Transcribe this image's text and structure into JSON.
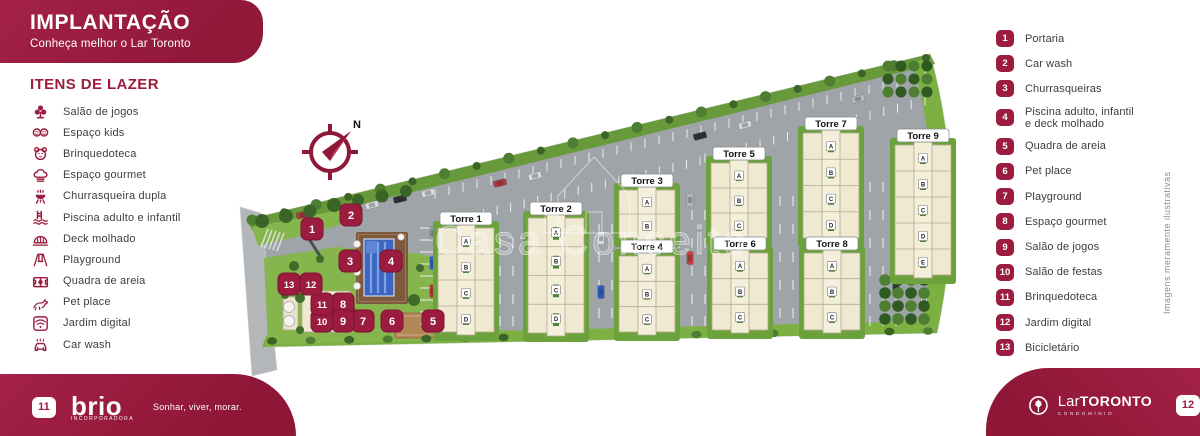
{
  "colors": {
    "brand": "#9b1c3f"
  },
  "header": {
    "title": "IMPLANTAÇÃO",
    "subtitle": "Conheça melhor o Lar Toronto"
  },
  "leisure": {
    "heading": "ITENS DE LAZER",
    "items": [
      {
        "icon": "game-room-icon",
        "label": "Salão de jogos"
      },
      {
        "icon": "kids-space-icon",
        "label": "Espaço kids"
      },
      {
        "icon": "toy-library-icon",
        "label": "Brinquedoteca"
      },
      {
        "icon": "gourmet-icon",
        "label": "Espaço gourmet"
      },
      {
        "icon": "bbq-icon",
        "label": "Churrasqueira dupla"
      },
      {
        "icon": "pool-icon",
        "label": "Piscina adulto e infantil"
      },
      {
        "icon": "wet-deck-icon",
        "label": "Deck molhado"
      },
      {
        "icon": "playground-icon",
        "label": "Playground"
      },
      {
        "icon": "sand-court-icon",
        "label": "Quadra de areia"
      },
      {
        "icon": "pet-place-icon",
        "label": "Pet place"
      },
      {
        "icon": "digital-garden-icon",
        "label": "Jardim digital"
      },
      {
        "icon": "car-wash-icon",
        "label": "Car wash"
      }
    ]
  },
  "legend": {
    "items": [
      {
        "number": "1",
        "label": "Portaria"
      },
      {
        "number": "2",
        "label": "Car wash"
      },
      {
        "number": "3",
        "label": "Churrasqueiras"
      },
      {
        "number": "4",
        "label": "Piscina adulto, infantil\ne deck molhado"
      },
      {
        "number": "5",
        "label": "Quadra de areia"
      },
      {
        "number": "6",
        "label": "Pet place"
      },
      {
        "number": "7",
        "label": "Playground"
      },
      {
        "number": "8",
        "label": "Espaço gourmet"
      },
      {
        "number": "9",
        "label": "Salão de jogos"
      },
      {
        "number": "10",
        "label": "Salão de festas"
      },
      {
        "number": "11",
        "label": "Brinquedoteca"
      },
      {
        "number": "12",
        "label": "Jardim digital"
      },
      {
        "number": "13",
        "label": "Bicicletário"
      }
    ]
  },
  "plan": {
    "watermark": "Casa Conceito",
    "compass_label": "N",
    "towers": [
      {
        "name": "Torre 1",
        "cx": 466,
        "top": 228,
        "h": 104,
        "sections": [
          "A",
          "B",
          "C",
          "D"
        ]
      },
      {
        "name": "Torre 2",
        "cx": 556,
        "top": 218,
        "h": 115,
        "sections": [
          "A",
          "B",
          "C",
          "D"
        ]
      },
      {
        "name": "Torre 3",
        "cx": 647,
        "top": 190,
        "h": 48,
        "sections": [
          "A",
          "B"
        ]
      },
      {
        "name": "Torre 4",
        "cx": 647,
        "top": 256,
        "h": 76,
        "sections": [
          "A",
          "B",
          "C"
        ]
      },
      {
        "name": "Torre 5",
        "cx": 739,
        "top": 163,
        "h": 75,
        "sections": [
          "A",
          "B",
          "C"
        ]
      },
      {
        "name": "Torre 6",
        "cx": 740,
        "top": 253,
        "h": 77,
        "sections": [
          "A",
          "B",
          "C"
        ]
      },
      {
        "name": "Torre 7",
        "cx": 831,
        "top": 133,
        "h": 105,
        "sections": [
          "A",
          "B",
          "C",
          "D"
        ]
      },
      {
        "name": "Torre 8",
        "cx": 832,
        "top": 253,
        "h": 77,
        "sections": [
          "A",
          "B",
          "C"
        ]
      },
      {
        "name": "Torre 9",
        "cx": 923,
        "top": 145,
        "h": 130,
        "sections": [
          "A",
          "B",
          "C",
          "D",
          "E"
        ]
      }
    ],
    "markers": [
      {
        "number": "1",
        "x": 312,
        "y": 229
      },
      {
        "number": "2",
        "x": 351,
        "y": 215
      },
      {
        "number": "3",
        "x": 350,
        "y": 261
      },
      {
        "number": "4",
        "x": 391,
        "y": 261
      },
      {
        "number": "5",
        "x": 433,
        "y": 321
      },
      {
        "number": "6",
        "x": 392,
        "y": 321
      },
      {
        "number": "7",
        "x": 363,
        "y": 321
      },
      {
        "number": "8",
        "x": 343,
        "y": 304
      },
      {
        "number": "9",
        "x": 343,
        "y": 321
      },
      {
        "number": "10",
        "x": 322,
        "y": 321
      },
      {
        "number": "11",
        "x": 322,
        "y": 304
      },
      {
        "number": "12",
        "x": 311,
        "y": 284
      },
      {
        "number": "13",
        "x": 289,
        "y": 284
      }
    ]
  },
  "disclaimer": "Imagens meramente ilustrativas",
  "footer_left": {
    "badge": "11",
    "brand": "brio",
    "brand_sub": "incorporadora",
    "tagline": "Sonhar, viver, morar."
  },
  "footer_right": {
    "badge": "12",
    "brand_prefix": "Lar",
    "brand": "TORONTO",
    "brand_sub": "CONDOMÍNIO"
  }
}
